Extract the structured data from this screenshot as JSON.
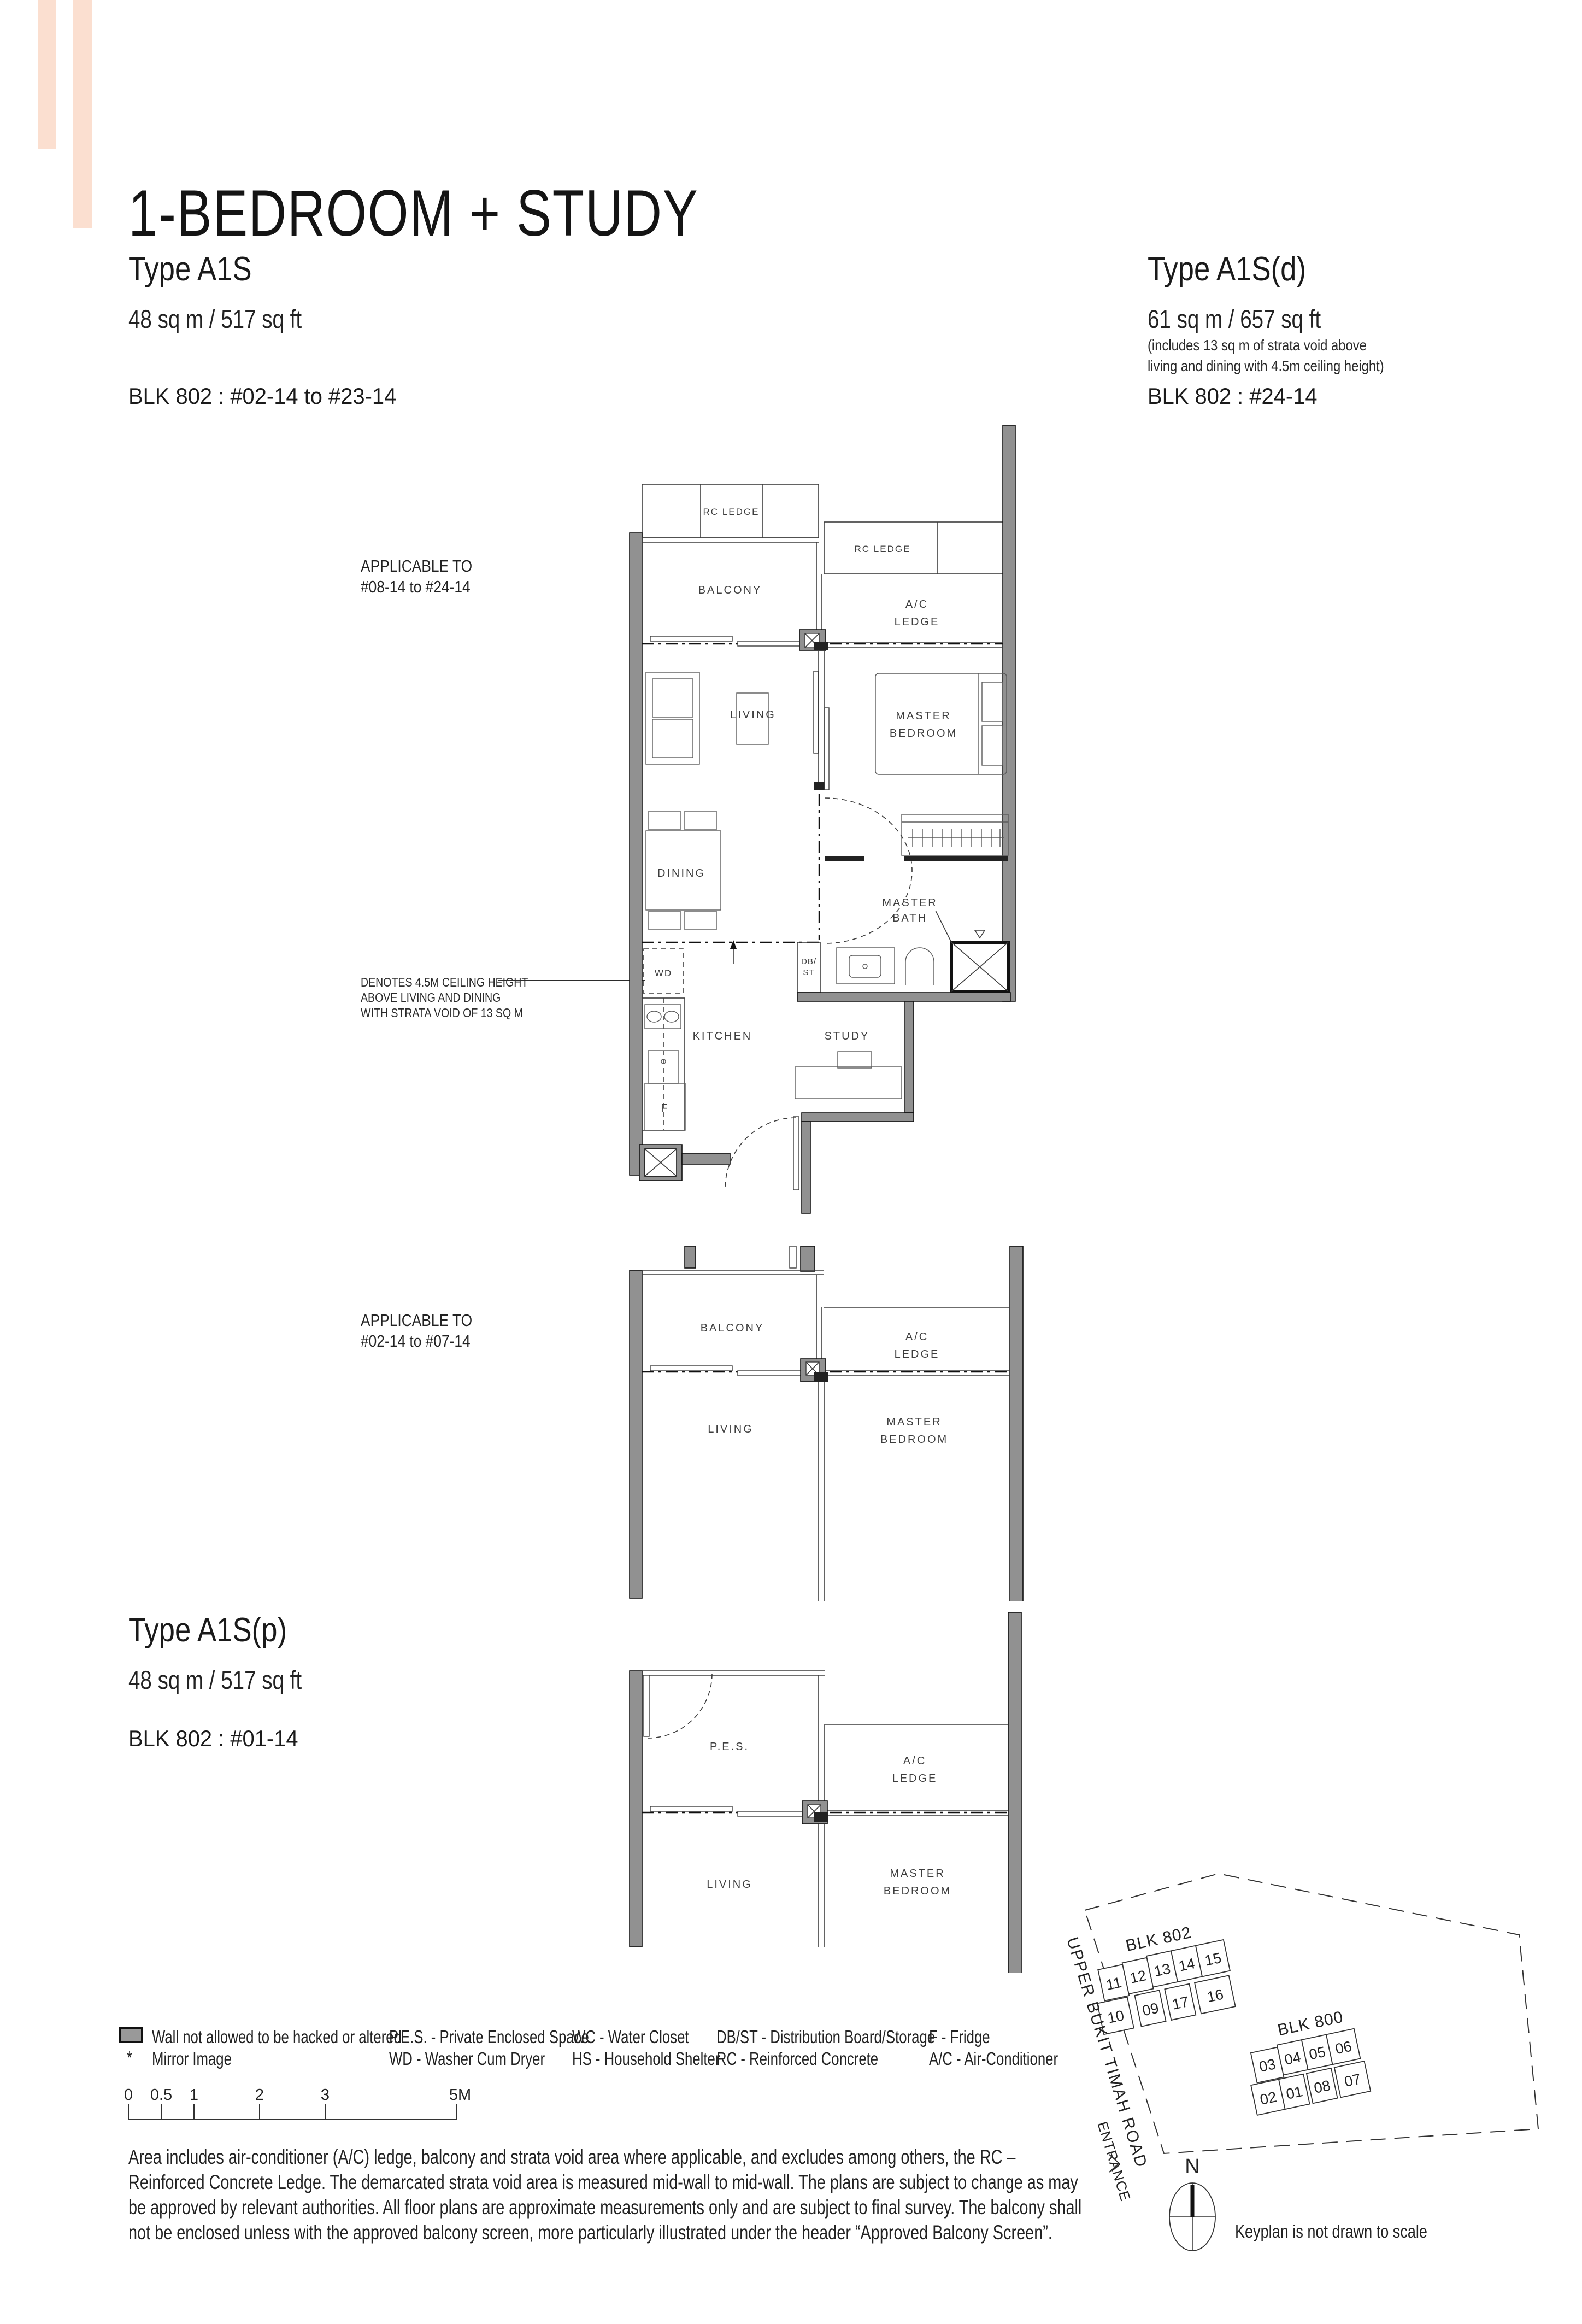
{
  "header": {
    "title": "1-BEDROOM + STUDY"
  },
  "types": {
    "a1s": {
      "name": "Type A1S",
      "area": "48 sq m / 517 sq ft",
      "block": "BLK 802 : #02-14 to #23-14"
    },
    "a1sd": {
      "name": "Type A1S(d)",
      "area": "61 sq m / 657 sq ft",
      "note1": "(includes 13 sq m of strata void above",
      "note2": "living and dining with 4.5m ceiling height)",
      "block": "BLK 802 : #24-14"
    },
    "a1sp": {
      "name": "Type A1S(p)",
      "area": "48 sq m / 517 sq ft",
      "block": "BLK 802 : #01-14"
    }
  },
  "plan1": {
    "applicable1": "APPLICABLE TO",
    "applicable2": "#08-14 to #24-14",
    "note1": "DENOTES 4.5M CEILING HEIGHT",
    "note2": "ABOVE LIVING AND DINING",
    "note3": "WITH STRATA VOID OF 13 SQ M",
    "rooms": {
      "rc_left": "RC LEDGE",
      "rc_right": "RC LEDGE",
      "balcony": "BALCONY",
      "ac1": "A/C",
      "ac2": "LEDGE",
      "living": "LIVING",
      "mb1": "MASTER",
      "mb2": "BEDROOM",
      "dining": "DINING",
      "bath1": "MASTER",
      "bath2": "BATH",
      "wd": "WD",
      "db1": "DB/",
      "db2": "ST",
      "kitchen": "KITCHEN",
      "study": "STUDY",
      "fridge": "F"
    }
  },
  "plan2": {
    "applicable1": "APPLICABLE TO",
    "applicable2": "#02-14 to #07-14",
    "rooms": {
      "balcony": "BALCONY",
      "ac1": "A/C",
      "ac2": "LEDGE",
      "living": "LIVING",
      "mb1": "MASTER",
      "mb2": "BEDROOM"
    }
  },
  "plan3": {
    "rooms": {
      "pes": "P.E.S.",
      "ac1": "A/C",
      "ac2": "LEDGE",
      "living": "LIVING",
      "mb1": "MASTER",
      "mb2": "BEDROOM"
    }
  },
  "legend": {
    "wall": "Wall not allowed to be hacked or altered",
    "mirror_symbol": "*",
    "mirror": "Mirror Image",
    "pes": "P.E.S. - Private Enclosed Space",
    "wd": "WD - Washer Cum Dryer",
    "wc": "WC - Water Closet",
    "hs": "HS - Household Shelter",
    "dbst": "DB/ST - Distribution Board/Storage",
    "rc": "RC - Reinforced Concrete",
    "f": "F - Fridge",
    "ac": "A/C - Air-Conditioner"
  },
  "scalebar": {
    "t0": "0",
    "t05": "0.5",
    "t1": "1",
    "t2": "2",
    "t3": "3",
    "t5": "5M"
  },
  "disclaimer": "Area includes air-conditioner (A/C) ledge, balcony and strata void area where applicable, and excludes among others, the RC – Reinforced Concrete Ledge. The demarcated strata void area is measured mid-wall to mid-wall. The plans are subject to change as may be approved by relevant authorities. All floor plans are approximate measurements only and are subject to final survey. The balcony shall not be enclosed unless with the approved balcony screen, more particularly illustrated under the header “Approved Balcony Screen”.",
  "keyplan": {
    "blk802": "BLK 802",
    "blk800": "BLK 800",
    "u802": {
      "r1": [
        "11",
        "12",
        "13",
        "14",
        "15"
      ],
      "r2": [
        "10",
        "09",
        "17",
        "16"
      ]
    },
    "u800": {
      "r1": [
        "03",
        "04",
        "05",
        "06"
      ],
      "r2": [
        "02",
        "01",
        "08",
        "07"
      ]
    },
    "road": "UPPER BUKIT TIMAH ROAD",
    "entrance": "ENTRANCE",
    "north": "N",
    "caption": "Keyplan is not drawn to scale"
  },
  "colors": {
    "accent": "#fbdfd0",
    "highlight": "#f6cdb6",
    "wall": "#919191"
  }
}
